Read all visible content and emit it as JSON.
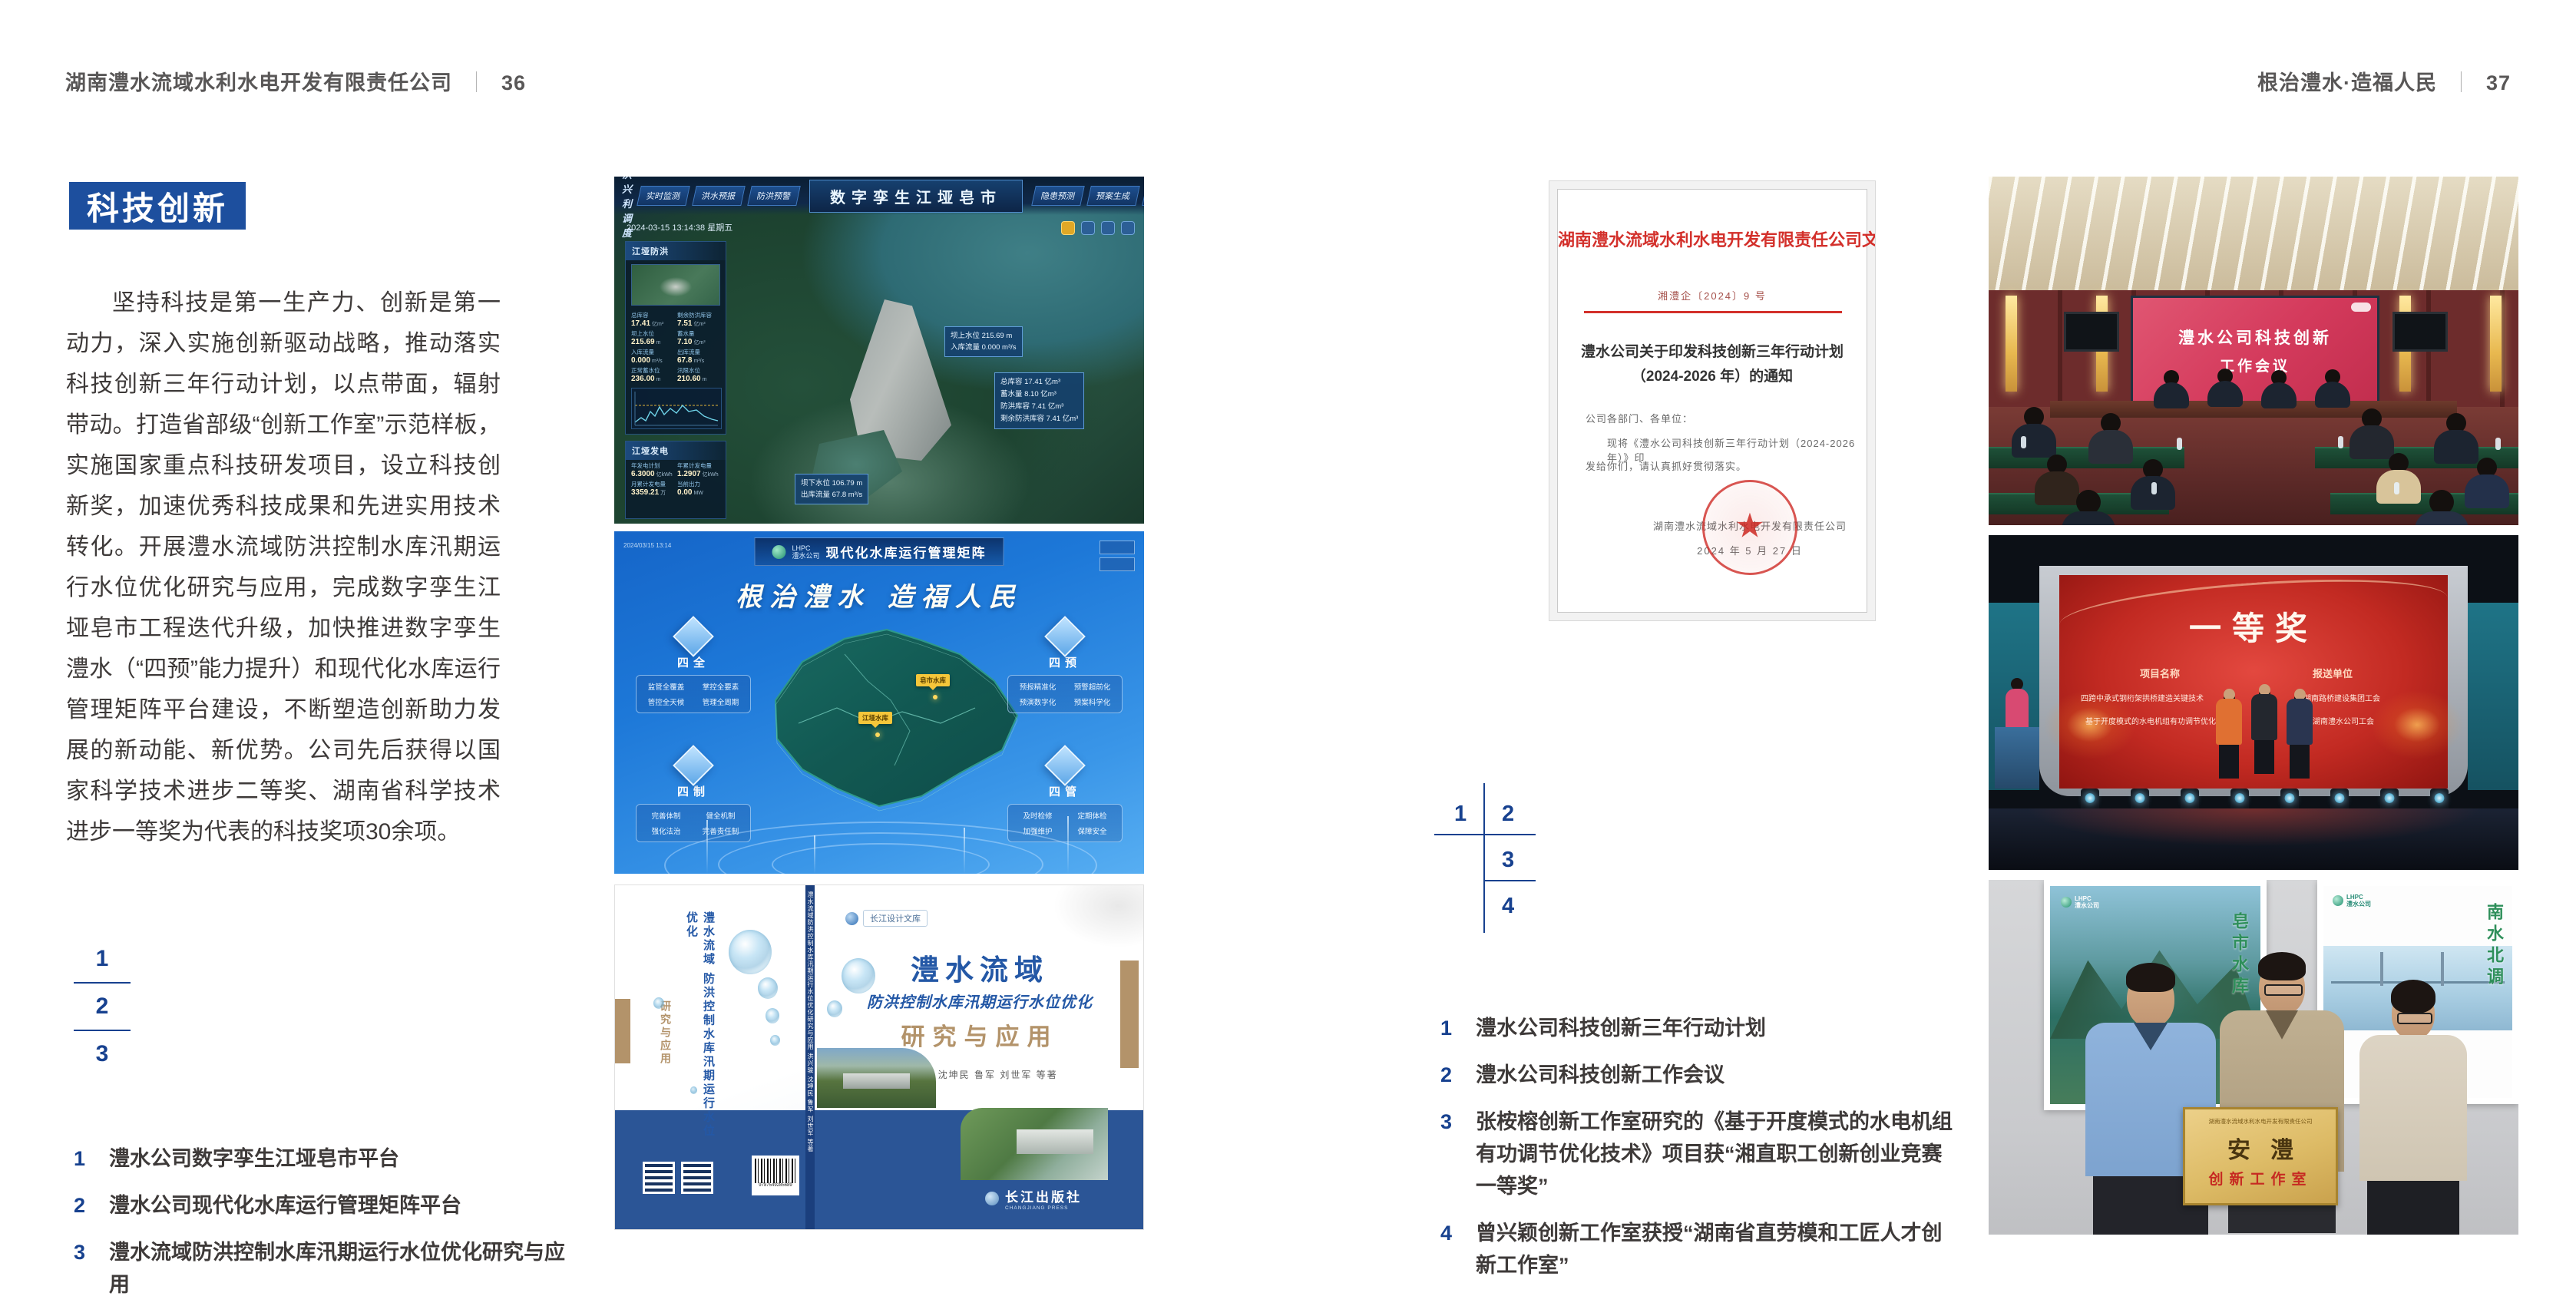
{
  "page_left": {
    "header": {
      "company": "湖南澧水流域水利水电开发有限责任公司",
      "sep": "｜",
      "page": "36"
    },
    "section_title": "科技创新",
    "body": "坚持科技是第一生产力、创新是第一动力，深入实施创新驱动战略，推动落实科技创新三年行动计划，以点带面，辐射带动。打造省部级“创新工作室”示范样板，实施国家重点科技研发项目，设立科技创新奖，加速优秀科技成果和先进实用技术转化。开展澧水流域防洪控制水库汛期运行水位优化研究与应用，完成数字孪生江垭皂市工程迭代升级，加快推进数字孪生澧水（“四预”能力提升）和现代化水库运行管理矩阵平台建设，不断塑造创新助力发展的新动能、新优势。公司先后获得以国家科学技术进步二等奖、湖南省科学技术进步一等奖为代表的科技奖项30余项。",
    "index": {
      "n1": "1",
      "n2": "2",
      "n3": "3"
    },
    "captions": [
      {
        "num": "1",
        "text": "澧水公司数字孪生江垭皂市平台"
      },
      {
        "num": "2",
        "text": "澧水公司现代化水库运行管理矩阵平台"
      },
      {
        "num": "3",
        "text": "澧水流域防洪控制水库汛期运行水位优化研究与应用"
      }
    ]
  },
  "page_right": {
    "header": {
      "motto": "根治澧水·造福人民",
      "sep": "｜",
      "page": "37"
    },
    "index": {
      "n1": "1",
      "n2": "2",
      "n3": "3",
      "n4": "4"
    },
    "captions": [
      {
        "num": "1",
        "text": "澧水公司科技创新三年行动计划"
      },
      {
        "num": "2",
        "text": "澧水公司科技创新工作会议"
      },
      {
        "num": "3",
        "text": "张桉榕创新工作室研究的《基于开度模式的水电机组有功调节优化技术》项目获“湘直职工创新创业竞赛一等奖”"
      },
      {
        "num": "4",
        "text": "曾兴颖创新工作室获授“湖南省直劳模和工匠人才创新工作室”"
      }
    ]
  },
  "dashboard": {
    "badge": "防洪兴利调度",
    "tabs_left": [
      "实时监测",
      "洪水预报",
      "防洪预警"
    ],
    "title": "数字孪生江垭皂市",
    "tabs_right": [
      "隐患预测",
      "预案生成",
      "调度执行",
      "工程巡检"
    ],
    "datetime": "2024-03-15 13:14:38 星期五",
    "panel1": {
      "title": "江垭防洪",
      "stats": [
        {
          "label": "总库容",
          "value": "17.41",
          "unit": "亿m³"
        },
        {
          "label": "剩余防洪库容",
          "value": "7.51",
          "unit": "亿m³"
        },
        {
          "label": "坝上水位",
          "value": "215.69",
          "unit": "m"
        },
        {
          "label": "蓄水量",
          "value": "7.10",
          "unit": "亿m³"
        },
        {
          "label": "入库流量",
          "value": "0.000",
          "unit": "m³/s"
        },
        {
          "label": "出库流量",
          "value": "67.8",
          "unit": "m³/s"
        },
        {
          "label": "正常蓄水位",
          "value": "236.00",
          "unit": "m"
        },
        {
          "label": "汛限水位",
          "value": "210.60",
          "unit": "m"
        }
      ]
    },
    "panel2": {
      "title": "江垭发电",
      "stats": [
        {
          "label": "年发电计划",
          "value": "6.3000",
          "unit": "亿kWh"
        },
        {
          "label": "年累计发电量",
          "value": "1.2907",
          "unit": "亿kWh"
        },
        {
          "label": "月累计发电量",
          "value": "3359.21",
          "unit": "万"
        },
        {
          "label": "当前出力",
          "value": "0.00",
          "unit": "MW"
        }
      ]
    },
    "callout1": {
      "l1": "坝上水位 215.69 m",
      "l2": "入库流量 0.000 m³/s"
    },
    "callout2": [
      "总库容 17.41 亿m³",
      "蓄水量 8.10 亿m³",
      "防洪库容 7.41 亿m³",
      "剩余防洪库容 7.41 亿m³"
    ],
    "callout3": {
      "l1": "坝下水位 106.79 m",
      "l2": "出库流量 67.8 m³/s"
    }
  },
  "matrix": {
    "logo_line1": "LHPC",
    "logo_line2": "澧水公司",
    "title": "现代化水库运行管理矩阵",
    "slogan": "根治澧水 造福人民",
    "groups": [
      {
        "name": "四全",
        "items": [
          "监管全覆盖",
          "掌控全要素",
          "管控全天候",
          "管理全周期"
        ]
      },
      {
        "name": "四预",
        "items": [
          "预报精准化",
          "预警超前化",
          "预演数字化",
          "预案科学化"
        ]
      },
      {
        "name": "四制",
        "items": [
          "完善体制",
          "健全机制",
          "强化法治",
          "完善责任制"
        ]
      },
      {
        "name": "四管",
        "items": [
          "及时检修",
          "定期体检",
          "加强维护",
          "保障安全"
        ]
      }
    ],
    "markers": [
      "皂市水库",
      "江垭水库"
    ]
  },
  "book": {
    "series": "长江设计文库",
    "title1": "澧水流域",
    "title2": "防洪控制水库汛期运行水位优化",
    "title3": "研究与应用",
    "authors": "洪兴骏  沈坤民  鲁军  刘世军  等著",
    "spine_text": "澧水流域防洪控制水库汛期运行水位优化研究与应用  洪兴骏 沈坤民 鲁军 刘世军 等著",
    "back_title12": "澧水流域 防洪控制水库汛期运行水位优化",
    "back_title3": "研究与应用",
    "publisher": "长江出版社",
    "publisher_sub": "CHANGJIANG PRESS",
    "barcode_num": "9787549285689"
  },
  "document": {
    "header": "湖南澧水流域水利水电开发有限责任公司文件",
    "doc_no": "湘澧企〔2024〕9 号",
    "title1": "澧水公司关于印发科技创新三年行动计划",
    "title2": "（2024-2026 年）的通知",
    "salutation": "公司各部门、各单位：",
    "body1": "现将《澧水公司科技创新三年行动计划（2024-2026 年）》印",
    "body2": "发给你们，请认真抓好贯彻落实。",
    "signer": "湖南澧水流域水利水电开发有限责任公司",
    "date": "2024 年 5 月 27 日",
    "seal_star": "★"
  },
  "meeting": {
    "screen_line1": "澧水公司科技创新",
    "screen_line2": "工作会议"
  },
  "award": {
    "title": "一等奖",
    "col1": "项目名称",
    "col2": "报送单位",
    "rows": [
      {
        "project": "四跨中承式钢桁架拱桥建造关键技术",
        "org": "湖南路桥建设集团工会"
      },
      {
        "project": "基于开度模式的水电机组有功调节优化技术",
        "org": "湖南澧水公司工会"
      }
    ]
  },
  "plaque": {
    "header": "湖南澧水流域水利水电开发有限责任公司",
    "big": "安澧",
    "sub": "创新工作室",
    "poster_left_logo1": "LHPC",
    "poster_left_logo2": "澧水公司",
    "poster_left_vtext": "皂市水库",
    "poster_right_logo1": "LHPC",
    "poster_right_logo2": "澧水公司",
    "poster_right_vtext": "南水北调"
  }
}
